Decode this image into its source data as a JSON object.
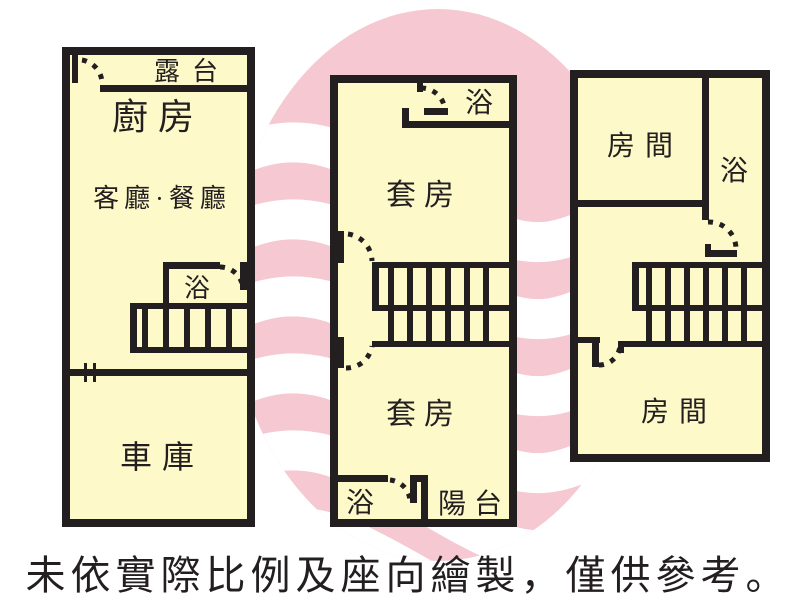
{
  "colors": {
    "room_fill": "#fdf9c9",
    "wall": "#231f20",
    "text": "#231f20",
    "circle_pink": "#f5c8d2",
    "stripe_white": "#ffffff"
  },
  "caption": "未依實際比例及座向繪製，僅供參考。",
  "plans": [
    {
      "name": "left-floor-plan",
      "rooms": {
        "terrace": "露台",
        "kitchen": "廚房",
        "living_dining": "客廳·餐廳",
        "bath": "浴",
        "garage": "車庫"
      }
    },
    {
      "name": "middle-floor-plan",
      "rooms": {
        "bath_top": "浴",
        "suite_upper": "套房",
        "suite_lower": "套房",
        "bath_bottom": "浴",
        "balcony": "陽台"
      }
    },
    {
      "name": "right-floor-plan",
      "rooms": {
        "room_top": "房間",
        "bath": "浴",
        "room_bottom": "房間"
      }
    }
  ]
}
